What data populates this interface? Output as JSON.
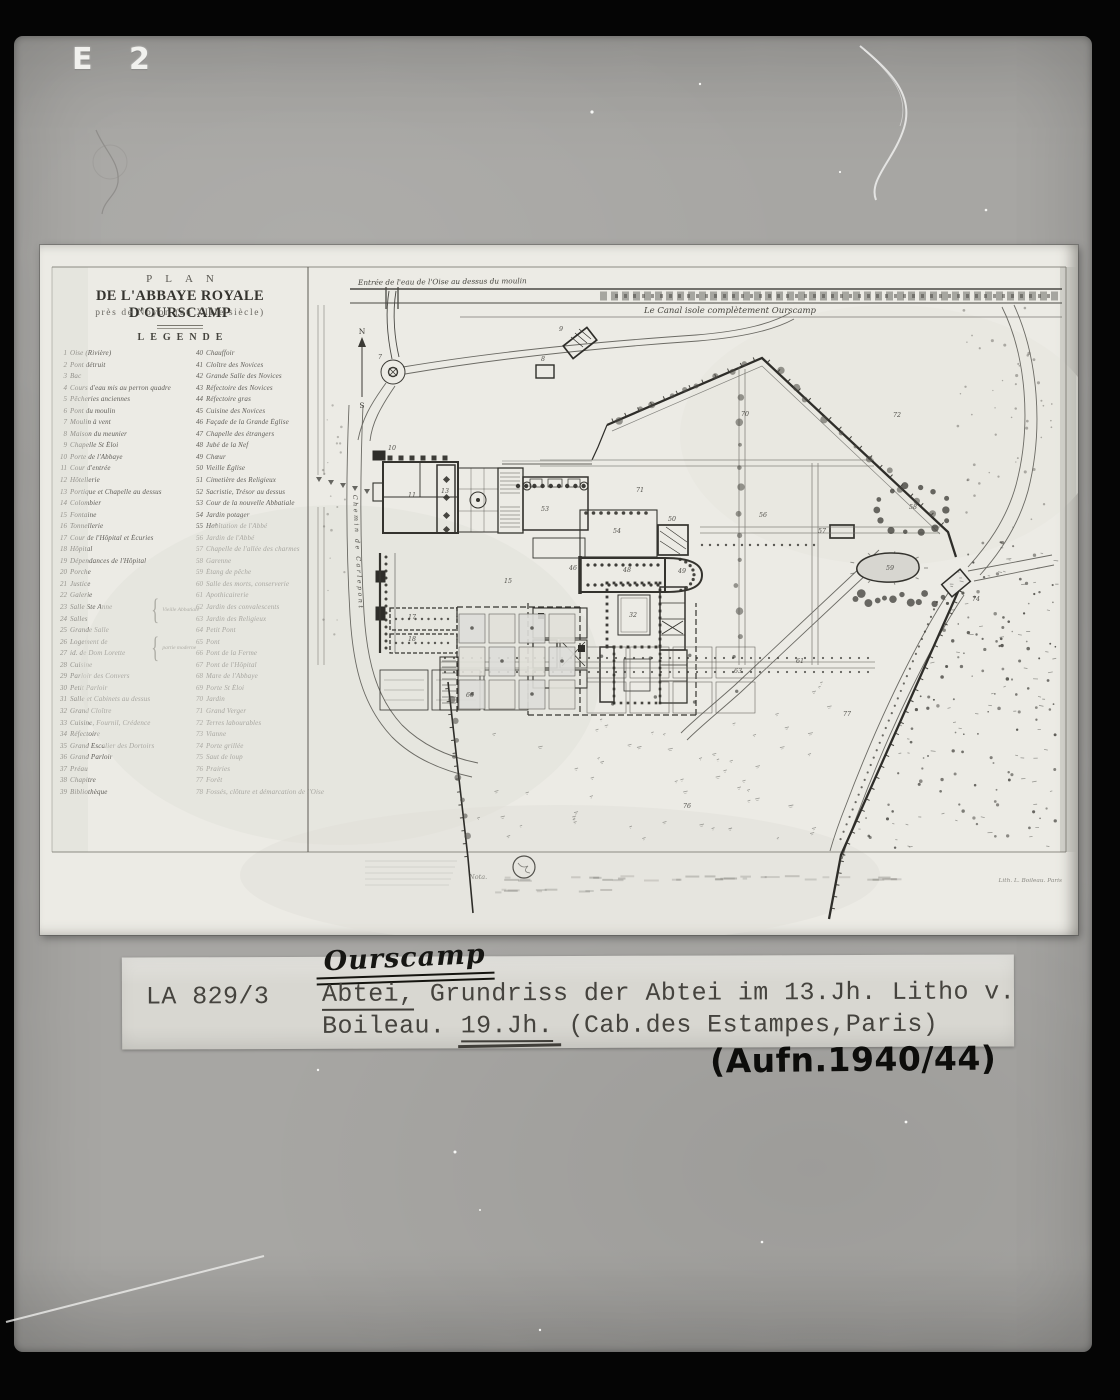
{
  "archive": {
    "corner_mark": "E 2",
    "label": {
      "inventory_no": "LA 829/3",
      "handwritten_title": "Ourscamp",
      "line1_underlined": "Abtei,",
      "line1_rest": " Grundriss der Abtei im 13.Jh. Litho v.",
      "line2_start": "Boileau. ",
      "line2_underlined": "19.Jh.",
      "line2_rest": " (Cab.des Estampes,Paris)",
      "handwritten_date": "(Aufn.1940/44)"
    }
  },
  "plan": {
    "title_line1": "PLAN",
    "title_line2": "DE L'ABBAYE ROYALE D'OURSCAMP",
    "title_line3": "près de Noyon (au XIIIe siècle)",
    "legend_heading": "LEGENDE",
    "legend_braces": [
      "Vieille Abbatiale",
      "partie moderne"
    ],
    "legend_col1": [
      {
        "n": "1",
        "t": "Oise (Rivière)"
      },
      {
        "n": "2",
        "t": "Pont détruit"
      },
      {
        "n": "3",
        "t": "Bac"
      },
      {
        "n": "4",
        "t": "Cours d'eau mis au perron quadre"
      },
      {
        "n": "5",
        "t": "Pêcheries anciennes"
      },
      {
        "n": "6",
        "t": "Pont du moulin"
      },
      {
        "n": "7",
        "t": "Moulin à vent"
      },
      {
        "n": "8",
        "t": "Maison du meunier"
      },
      {
        "n": "9",
        "t": "Chapelle St Éloi"
      },
      {
        "n": "10",
        "t": "Porte de l'Abbaye"
      },
      {
        "n": "11",
        "t": "Cour d'entrée"
      },
      {
        "n": "12",
        "t": "Hôtellerie"
      },
      {
        "n": "13",
        "t": "Portique et Chapelle au dessus"
      },
      {
        "n": "14",
        "t": "Colombier"
      },
      {
        "n": "15",
        "t": "Fontaine"
      },
      {
        "n": "16",
        "t": "Tonnellerie"
      },
      {
        "n": "17",
        "t": "Cour de l'Hôpital et Écuries"
      },
      {
        "n": "18",
        "t": "Hôpital"
      },
      {
        "n": "19",
        "t": "Dépendances de l'Hôpital"
      },
      {
        "n": "20",
        "t": "Porche"
      },
      {
        "n": "21",
        "t": "Justice"
      },
      {
        "n": "22",
        "t": "Galerie"
      },
      {
        "n": "23",
        "t": "Salle Ste Anne"
      },
      {
        "n": "24",
        "t": "Salles"
      },
      {
        "n": "25",
        "t": "Grande Salle"
      },
      {
        "n": "26",
        "t": "Logement de"
      },
      {
        "n": "27",
        "t": "id. de Dom Lorette"
      },
      {
        "n": "28",
        "t": "Cuisine"
      },
      {
        "n": "29",
        "t": "Parloir des Convers"
      },
      {
        "n": "30",
        "t": "Petit Parloir"
      },
      {
        "n": "31",
        "t": "Salle et Cabinets au dessus"
      },
      {
        "n": "32",
        "t": "Grand Cloître"
      },
      {
        "n": "33",
        "t": "Cuisine, Fournil, Crédence"
      },
      {
        "n": "34",
        "t": "Réfectoire"
      },
      {
        "n": "35",
        "t": "Grand Escalier des Dortoirs"
      },
      {
        "n": "36",
        "t": "Grand Parloir"
      },
      {
        "n": "37",
        "t": "Préau"
      },
      {
        "n": "38",
        "t": "Chapitre"
      },
      {
        "n": "39",
        "t": "Bibliothèque"
      }
    ],
    "legend_col2": [
      {
        "n": "40",
        "t": "Chauffoir"
      },
      {
        "n": "41",
        "t": "Cloître des Novices"
      },
      {
        "n": "42",
        "t": "Grande Salle des Novices"
      },
      {
        "n": "43",
        "t": "Réfectoire des Novices"
      },
      {
        "n": "44",
        "t": "Réfectoire gras"
      },
      {
        "n": "45",
        "t": "Cuisine des Novices"
      },
      {
        "n": "46",
        "t": "Façade de la Grande Église"
      },
      {
        "n": "47",
        "t": "Chapelle des étrangers"
      },
      {
        "n": "48",
        "t": "Jubé de la Nef"
      },
      {
        "n": "49",
        "t": "Chœur"
      },
      {
        "n": "50",
        "t": "Vieille Église"
      },
      {
        "n": "51",
        "t": "Cimetière des Religieux"
      },
      {
        "n": "52",
        "t": "Sacristie, Trésor au dessus"
      },
      {
        "n": "53",
        "t": "Cour de la nouvelle Abbatiale"
      },
      {
        "n": "54",
        "t": "Jardin potager"
      },
      {
        "n": "55",
        "t": "Habitation de l'Abbé"
      },
      {
        "n": "56",
        "t": "Jardin de l'Abbé"
      },
      {
        "n": "57",
        "t": "Chapelle de l'allée des charmes"
      },
      {
        "n": "58",
        "t": "Garenne"
      },
      {
        "n": "59",
        "t": "Étang de pêche"
      },
      {
        "n": "60",
        "t": "Salle des morts, conserverie"
      },
      {
        "n": "61",
        "t": "Apothicairerie"
      },
      {
        "n": "62",
        "t": "Jardin des convalescents"
      },
      {
        "n": "63",
        "t": "Jardin des Religieux"
      },
      {
        "n": "64",
        "t": "Petit Pont"
      },
      {
        "n": "65",
        "t": "Pont"
      },
      {
        "n": "66",
        "t": "Pont de la Ferme"
      },
      {
        "n": "67",
        "t": "Pont de l'Hôpital"
      },
      {
        "n": "68",
        "t": "Mare de l'Abbaye"
      },
      {
        "n": "69",
        "t": "Porte St Éloi"
      },
      {
        "n": "70",
        "t": "Jardin"
      },
      {
        "n": "71",
        "t": "Grand Verger"
      },
      {
        "n": "72",
        "t": "Terres labourables"
      },
      {
        "n": "73",
        "t": "Vianne"
      },
      {
        "n": "74",
        "t": "Porte grillée"
      },
      {
        "n": "75",
        "t": "Saut de loup"
      },
      {
        "n": "76",
        "t": "Prairies"
      },
      {
        "n": "77",
        "t": "Forêt"
      },
      {
        "n": "78",
        "t": "Fossés, clôture et démarcation de l'Oise"
      }
    ],
    "annotations": {
      "canal_entry": "Entrée de l'eau de l'Oise au dessus du moulin",
      "canal_main": "Le Canal isole complètement Ourscamp",
      "road_label": "Chemin de Carlepont",
      "compass_n": "N",
      "compass_s": "S",
      "nota": "Nota.",
      "credit": "Lith. L. Boileau. Paris"
    },
    "map_numbers": [
      {
        "t": "7",
        "x": 340,
        "y": 114
      },
      {
        "t": "8",
        "x": 503,
        "y": 116
      },
      {
        "t": "9",
        "x": 521,
        "y": 86
      },
      {
        "t": "10",
        "x": 352,
        "y": 205
      },
      {
        "t": "70",
        "x": 705,
        "y": 171
      },
      {
        "t": "72",
        "x": 857,
        "y": 172
      },
      {
        "t": "71",
        "x": 600,
        "y": 247
      },
      {
        "t": "56",
        "x": 723,
        "y": 272
      },
      {
        "t": "58",
        "x": 873,
        "y": 264
      },
      {
        "t": "59",
        "x": 850,
        "y": 325
      },
      {
        "t": "57",
        "x": 782,
        "y": 288
      },
      {
        "t": "53",
        "x": 505,
        "y": 266
      },
      {
        "t": "54",
        "x": 577,
        "y": 288
      },
      {
        "t": "46",
        "x": 533,
        "y": 325
      },
      {
        "t": "48",
        "x": 587,
        "y": 327
      },
      {
        "t": "49",
        "x": 642,
        "y": 328
      },
      {
        "t": "32",
        "x": 593,
        "y": 372
      },
      {
        "t": "50",
        "x": 632,
        "y": 276
      },
      {
        "t": "63",
        "x": 698,
        "y": 428
      },
      {
        "t": "61",
        "x": 760,
        "y": 418
      },
      {
        "t": "77",
        "x": 807,
        "y": 471
      },
      {
        "t": "76",
        "x": 647,
        "y": 563
      },
      {
        "t": "11",
        "x": 372,
        "y": 252
      },
      {
        "t": "13",
        "x": 405,
        "y": 248
      },
      {
        "t": "15",
        "x": 468,
        "y": 338
      },
      {
        "t": "74",
        "x": 936,
        "y": 356
      },
      {
        "t": "17",
        "x": 372,
        "y": 374
      },
      {
        "t": "18",
        "x": 372,
        "y": 396
      },
      {
        "t": "66",
        "x": 430,
        "y": 452
      }
    ]
  },
  "colors": {
    "card": "#a7a6a3",
    "paper": "#ecebe5",
    "ink": "#34332e",
    "caption_paper": "#d8d7d1",
    "background": "#050505"
  }
}
